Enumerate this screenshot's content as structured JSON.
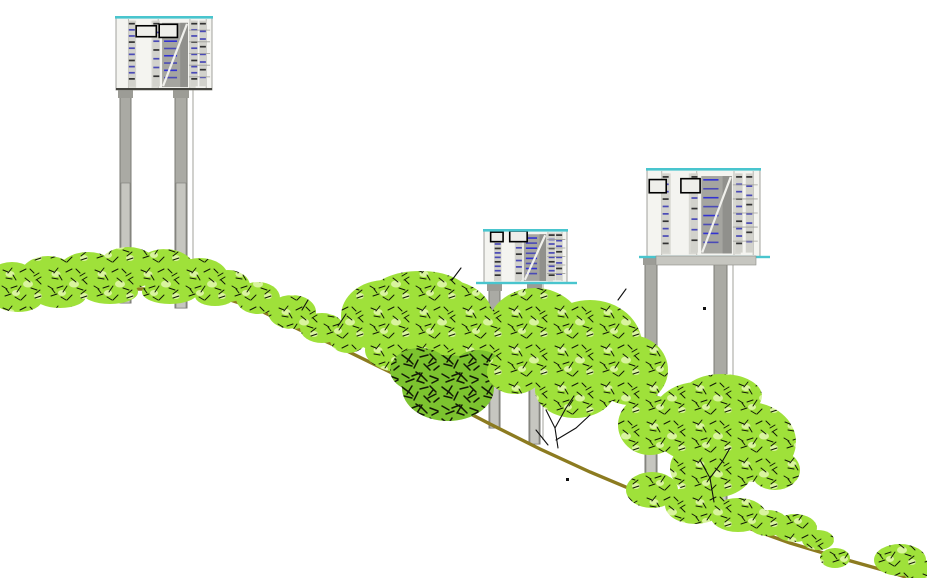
{
  "meta": {
    "title": "Hillside elevation drawing: three stilt-mounted building modules on a descending slope with vegetation"
  },
  "canvas": {
    "w": 927,
    "h": 578,
    "bg": "#ffffff"
  },
  "palette": {
    "ground": "#8c7b20",
    "veg_base": "#9fe13a",
    "veg_light": "#d9f49e",
    "veg_dark_base": "#7cc32f",
    "speckle": "#121a06",
    "pillar": "#aaaaa4",
    "pillar_lower": "#c6c6c0",
    "pillar_stroke": "#7b7b75",
    "pillar_cap": "#9c9c96",
    "facade_bg": "#f4f4f0",
    "facade_panel": "#d8d8d2",
    "facade_stair": "#a5a5a0",
    "facade_stair_dark": "#90908c",
    "facade_line": "#b8b8b2",
    "roof_line": "#49c5ce",
    "bottom_line": "#44443f",
    "window_stroke": "#000000",
    "mark_blue": "#4a4ab6",
    "mark_blue2": "#3232d2",
    "mark_dark": "#333333",
    "branch": "#101010"
  },
  "terrain": {
    "stroke_width": 3.4,
    "points": [
      [
        -6,
        300
      ],
      [
        50,
        294
      ],
      [
        120,
        289
      ],
      [
        170,
        289
      ],
      [
        215,
        295
      ],
      [
        255,
        308
      ],
      [
        300,
        330
      ],
      [
        345,
        350
      ],
      [
        390,
        372
      ],
      [
        440,
        398
      ],
      [
        490,
        424
      ],
      [
        540,
        449
      ],
      [
        590,
        472
      ],
      [
        640,
        493
      ],
      [
        690,
        511
      ],
      [
        740,
        525
      ],
      [
        790,
        543
      ],
      [
        840,
        558
      ],
      [
        890,
        572
      ],
      [
        918,
        581
      ]
    ]
  },
  "facade": {
    "mullions": [
      0.13,
      0.44,
      0.77,
      0.94
    ],
    "panels": [
      [
        0.13,
        0.05,
        0.08,
        0.92
      ],
      [
        0.37,
        0.05,
        0.07,
        0.92
      ],
      [
        0.77,
        0.05,
        0.06,
        0.92
      ]
    ],
    "stair": {
      "u": 0.48,
      "v": 0.08,
      "w": 0.27,
      "h": 0.88,
      "rows": 8
    },
    "dash_columns": [
      {
        "u": 0.165,
        "rows": 10
      },
      {
        "u": 0.42,
        "rows": 7
      },
      {
        "u": 0.815,
        "rows": 10
      },
      {
        "u": 0.905,
        "rows": 8
      }
    ],
    "line_rows": {
      "u": 0.76,
      "w": 0.22,
      "rows": 5
    }
  },
  "structures": [
    {
      "id": "stilt-module-1",
      "label": "upper-slope module",
      "building": {
        "x": 116,
        "y": 17,
        "w": 96,
        "h": 73
      },
      "base": "dark",
      "windows": [
        [
          0.21,
          0.12,
          0.21,
          0.15
        ],
        [
          0.45,
          0.1,
          0.19,
          0.18
        ]
      ],
      "pillars": [
        {
          "x": 120,
          "w": 11,
          "top": 90,
          "bottom": 303,
          "split": 183
        },
        {
          "x": 175,
          "w": 12,
          "top": 90,
          "bottom": 308,
          "split": 183
        }
      ],
      "edge_line": {
        "x": 193,
        "top": 90,
        "bottom": 296
      }
    },
    {
      "id": "stilt-module-2",
      "label": "mid-slope module",
      "building": {
        "x": 484,
        "y": 230,
        "w": 83,
        "h": 53
      },
      "base": "cyan",
      "windows": [
        [
          0.08,
          0.04,
          0.15,
          0.18
        ],
        [
          0.31,
          0.02,
          0.21,
          0.2
        ]
      ],
      "pillars": [
        {
          "x": 489,
          "w": 11,
          "top": 283,
          "bottom": 428,
          "split": 362
        },
        {
          "x": 529,
          "w": 11,
          "top": 283,
          "bottom": 444,
          "split": 362
        }
      ],
      "edge_line": {
        "x": 543,
        "top": 283,
        "bottom": 440
      }
    },
    {
      "id": "stilt-module-3",
      "label": "lower-slope module",
      "building": {
        "x": 647,
        "y": 169,
        "w": 113,
        "h": 88
      },
      "base": "cyan",
      "slab": {
        "x": 656,
        "y": 256,
        "w": 100,
        "h": 9
      },
      "windows": [
        [
          0.02,
          0.12,
          0.15,
          0.15
        ],
        [
          0.3,
          0.11,
          0.17,
          0.16
        ]
      ],
      "pillars": [
        {
          "x": 645,
          "w": 12,
          "top": 257,
          "bottom": 505,
          "split": 375
        },
        {
          "x": 714,
          "w": 13,
          "top": 257,
          "bottom": 512,
          "split": 375
        }
      ],
      "edge_line": {
        "x": 733,
        "top": 257,
        "bottom": 489
      }
    }
  ],
  "vegetation": {
    "clusters": [
      {
        "name": "shrub-row-hilltop",
        "kind": "bright",
        "ellipses": [
          [
            12,
            282,
            26,
            20
          ],
          [
            48,
            276,
            28,
            20
          ],
          [
            88,
            272,
            30,
            20
          ],
          [
            128,
            268,
            30,
            21
          ],
          [
            165,
            270,
            30,
            21
          ],
          [
            200,
            277,
            28,
            19
          ],
          [
            228,
            286,
            22,
            16
          ],
          [
            18,
            300,
            24,
            12
          ],
          [
            60,
            296,
            26,
            12
          ],
          [
            110,
            292,
            28,
            12
          ],
          [
            170,
            292,
            28,
            12
          ],
          [
            215,
            296,
            20,
            10
          ]
        ]
      },
      {
        "name": "shrub-row-upper-slope",
        "kind": "bright",
        "ellipses": [
          [
            258,
            298,
            22,
            16
          ],
          [
            292,
            312,
            24,
            17
          ],
          [
            322,
            328,
            22,
            15
          ],
          [
            348,
            340,
            18,
            13
          ]
        ]
      },
      {
        "name": "tree-group-left",
        "kind": "bright",
        "ellipses": [
          [
            385,
            316,
            44,
            36
          ],
          [
            445,
            318,
            48,
            38
          ],
          [
            420,
            293,
            48,
            22
          ],
          [
            475,
            345,
            30,
            25
          ],
          [
            400,
            350,
            35,
            22
          ]
        ]
      },
      {
        "name": "tree-dense-dark",
        "kind": "dark",
        "ellipses": [
          [
            448,
            388,
            46,
            33
          ],
          [
            420,
            370,
            30,
            22
          ],
          [
            478,
            368,
            25,
            18
          ]
        ]
      },
      {
        "name": "tree-middle",
        "kind": "bright",
        "ellipses": [
          [
            535,
            330,
            48,
            42
          ],
          [
            590,
            345,
            52,
            45
          ],
          [
            630,
            370,
            38,
            35
          ],
          [
            515,
            372,
            28,
            22
          ],
          [
            575,
            390,
            40,
            28
          ],
          [
            650,
            425,
            32,
            30
          ]
        ]
      },
      {
        "name": "tree-right",
        "kind": "bright",
        "ellipses": [
          [
            698,
            422,
            48,
            40
          ],
          [
            748,
            442,
            48,
            40
          ],
          [
            712,
            468,
            42,
            30
          ],
          [
            722,
            396,
            40,
            22
          ],
          [
            775,
            470,
            25,
            20
          ]
        ]
      },
      {
        "name": "shrub-row-lower-slope",
        "kind": "bright",
        "ellipses": [
          [
            652,
            490,
            26,
            18
          ],
          [
            695,
            505,
            30,
            19
          ],
          [
            738,
            515,
            28,
            17
          ],
          [
            768,
            523,
            20,
            13
          ]
        ]
      },
      {
        "name": "shrub-row-bottom-right",
        "kind": "bright",
        "ellipses": [
          [
            795,
            528,
            22,
            14
          ],
          [
            818,
            540,
            16,
            10
          ],
          [
            835,
            558,
            15,
            10
          ],
          [
            900,
            560,
            26,
            16
          ],
          [
            922,
            572,
            18,
            12
          ]
        ]
      }
    ]
  },
  "branches": [
    [
      [
        558,
        448
      ],
      [
        555,
        428
      ],
      [
        546,
        410
      ]
    ],
    [
      [
        555,
        428
      ],
      [
        566,
        408
      ],
      [
        574,
        396
      ]
    ],
    [
      [
        556,
        440
      ],
      [
        576,
        428
      ],
      [
        590,
        415
      ]
    ],
    [
      [
        548,
        445
      ],
      [
        536,
        430
      ]
    ],
    [
      [
        714,
        502
      ],
      [
        710,
        478
      ],
      [
        700,
        460
      ]
    ],
    [
      [
        710,
        478
      ],
      [
        722,
        462
      ],
      [
        730,
        448
      ]
    ],
    [
      [
        302,
        310
      ],
      [
        308,
        300
      ]
    ],
    [
      [
        338,
        326
      ],
      [
        346,
        314
      ]
    ],
    [
      [
        452,
        280
      ],
      [
        461,
        268
      ]
    ],
    [
      [
        618,
        300
      ],
      [
        626,
        289
      ]
    ]
  ],
  "marks": [
    [
      703,
      307
    ],
    [
      566,
      478
    ]
  ]
}
